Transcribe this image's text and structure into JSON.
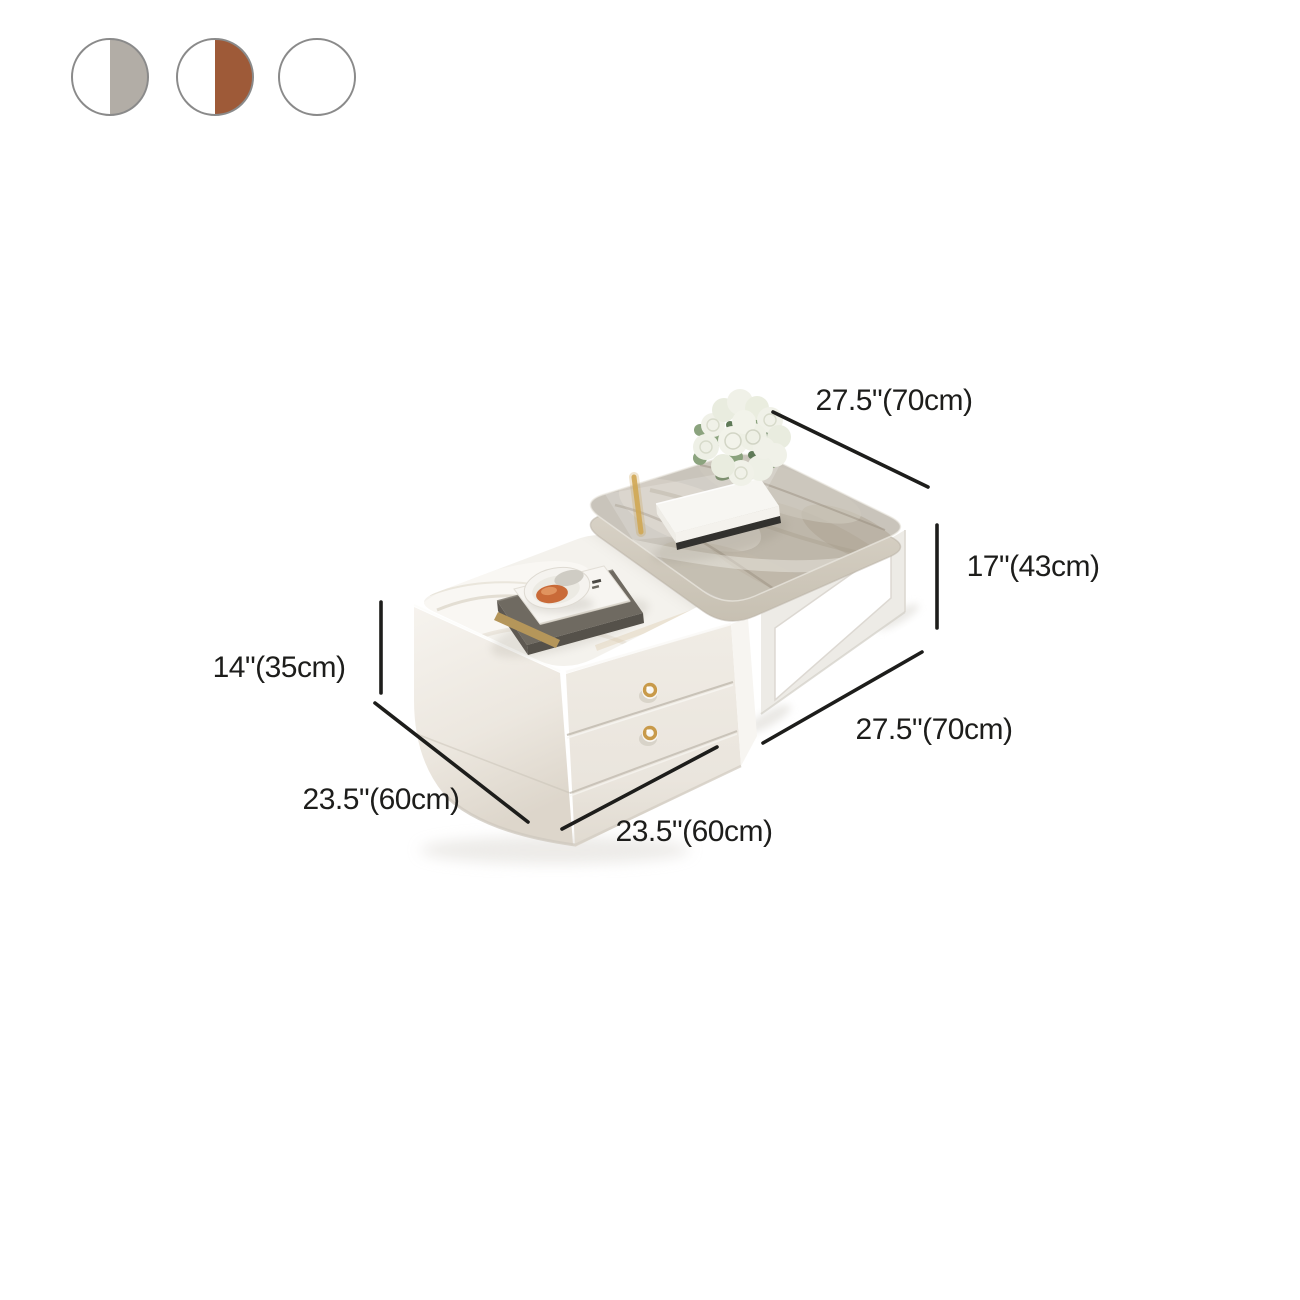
{
  "swatches": {
    "border": "#8a8a8a",
    "items": [
      {
        "name": "grey-white",
        "left": "#ffffff",
        "right": "#b2ada6"
      },
      {
        "name": "brown-white",
        "left": "#ffffff",
        "right": "#9e5a38"
      },
      {
        "name": "white",
        "left": "#ffffff",
        "right": "#ffffff"
      }
    ]
  },
  "dimensions": {
    "large_table_width": "27.5\"(70cm)",
    "large_table_height": "17\"(43cm)",
    "large_table_depth": "27.5\"(70cm)",
    "small_table_height": "14\"(35cm)",
    "small_table_depth": "23.5\"(60cm)",
    "small_table_width": "23.5\"(60cm)"
  },
  "colors": {
    "background": "#ffffff",
    "dimension_line": "#1d1d1b",
    "label_text": "#1d1d1b",
    "swatch_border": "#8a8a8a",
    "marble_grey": "#c9c4bb",
    "body_white": "#eee9e2",
    "knob_gold": "#c89a4a"
  }
}
